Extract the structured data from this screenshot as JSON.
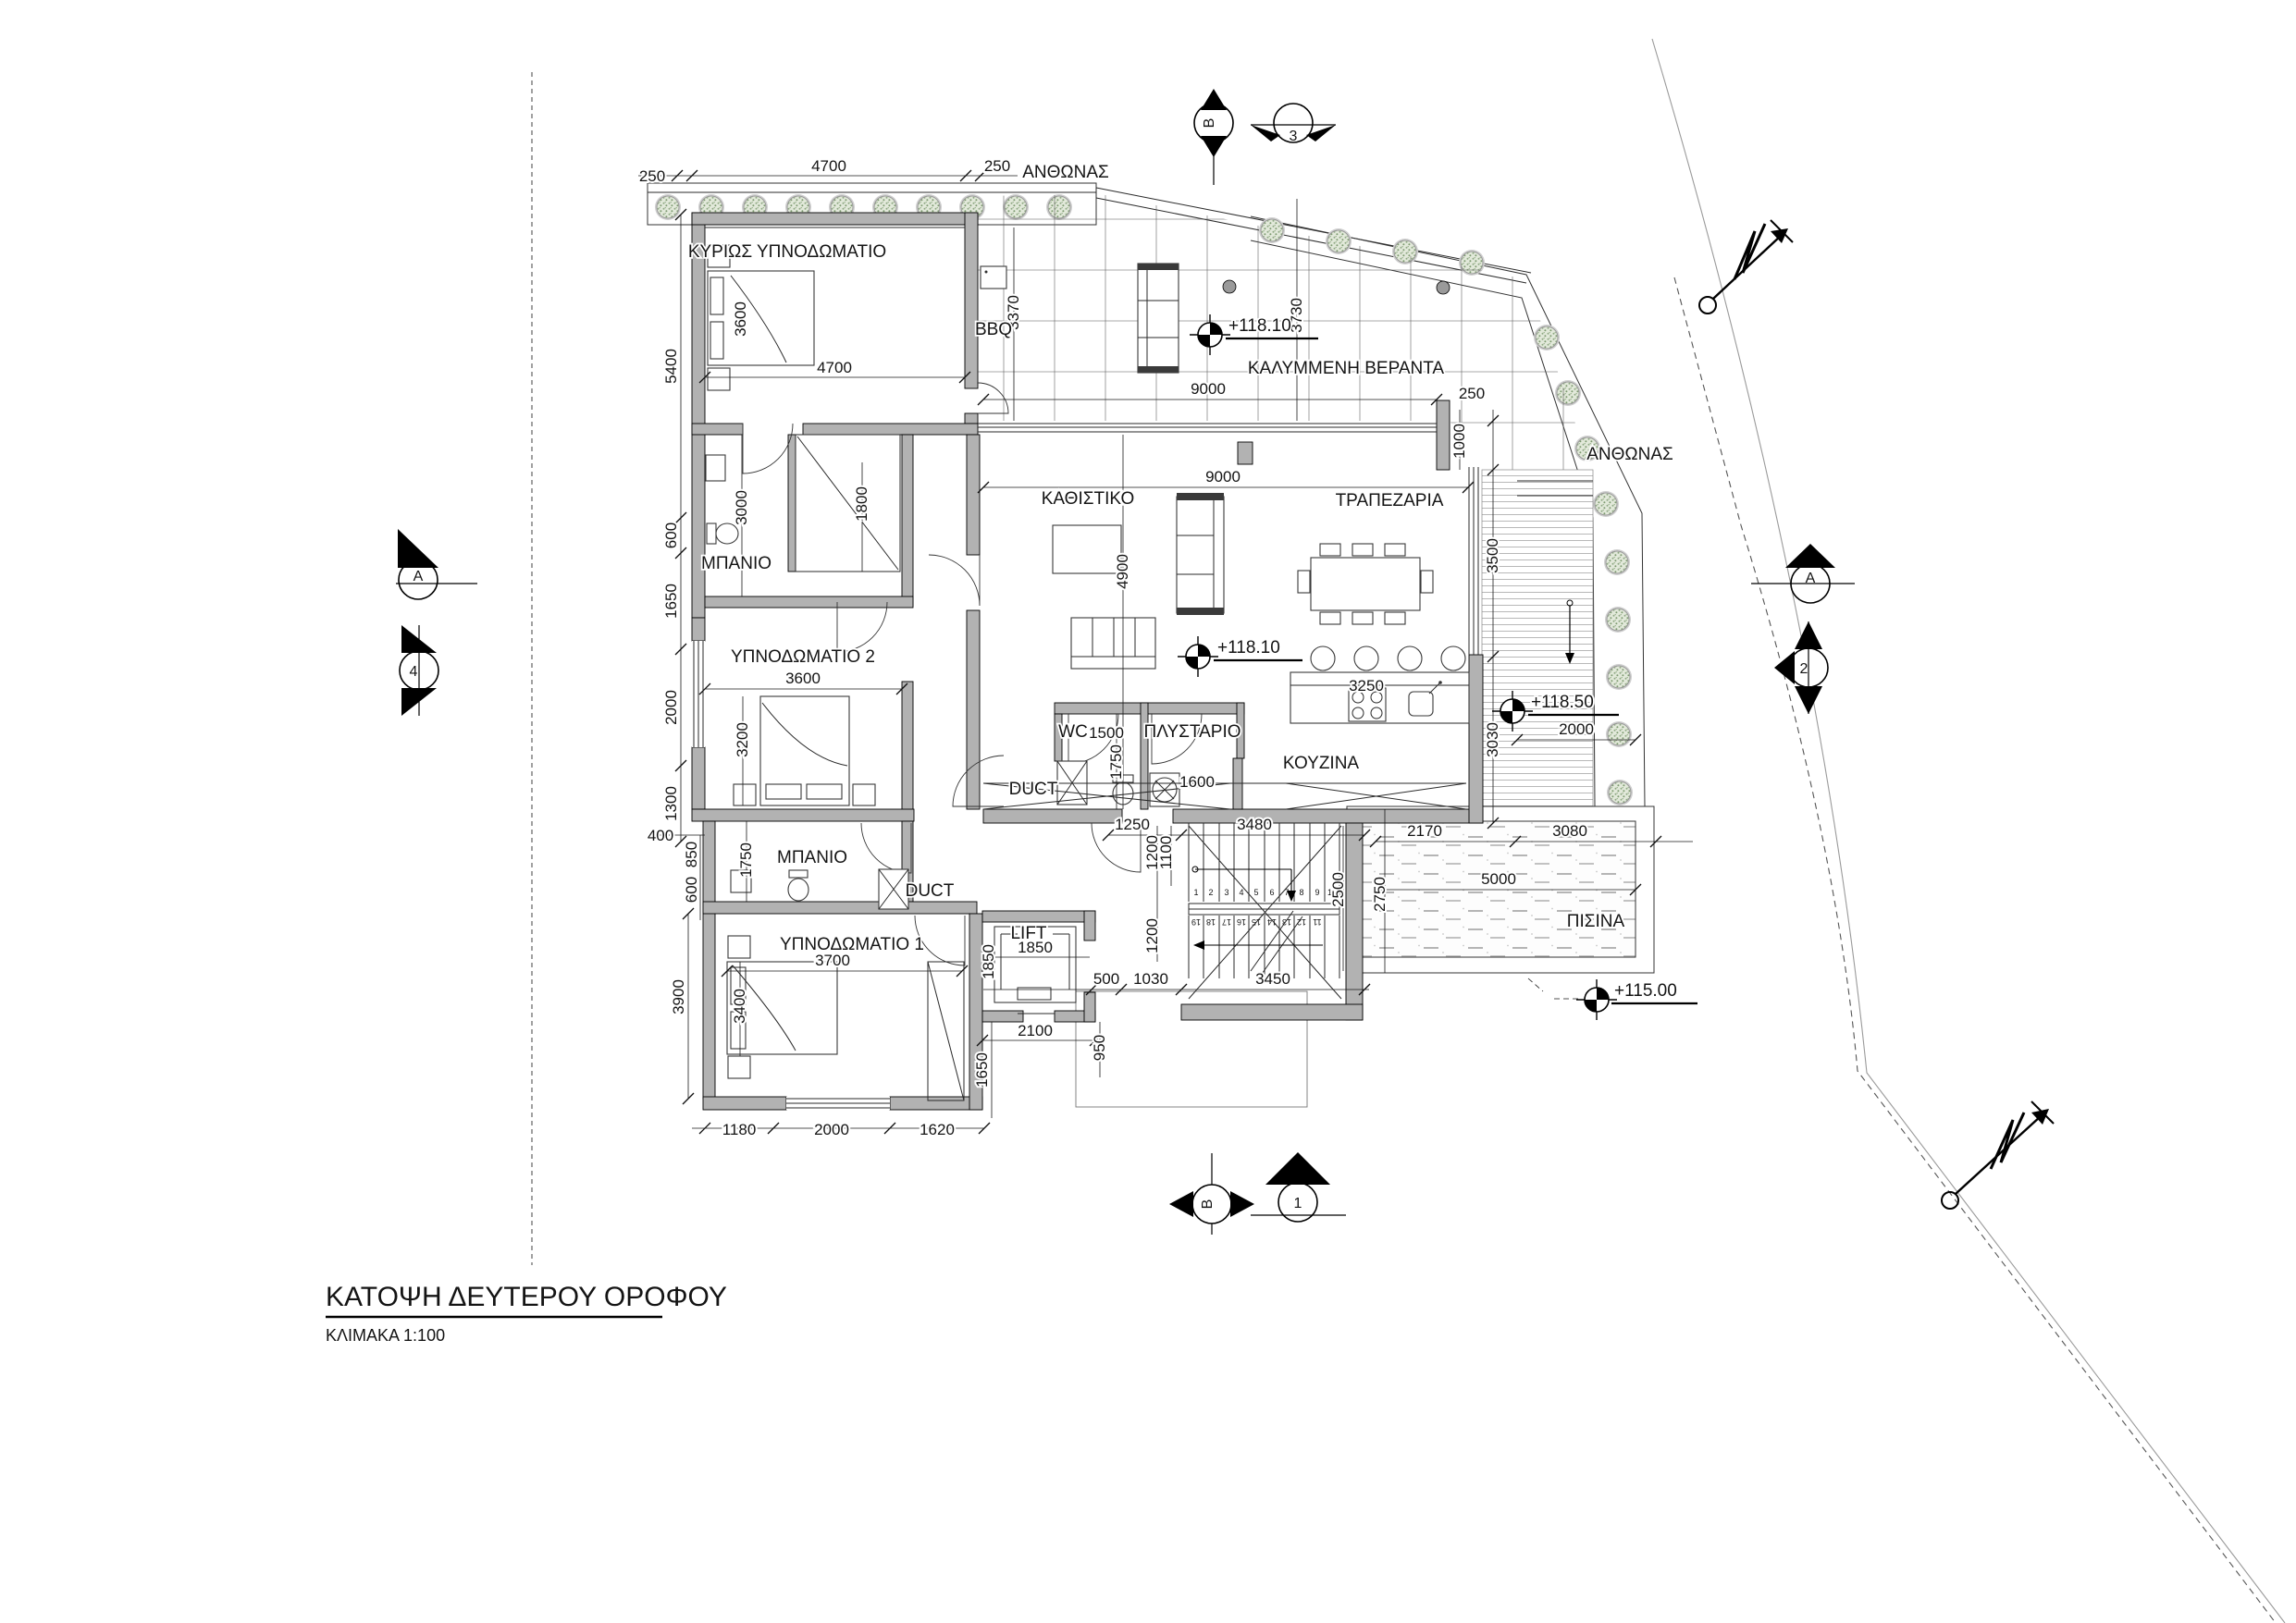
{
  "title": {
    "main": "ΚΑΤΟΨΗ ΔΕΥΤΕΡΟΥ ΟΡΟΦΟΥ",
    "scale": "ΚΛΙΜΑΚΑ 1:100"
  },
  "rooms": {
    "master": "ΚΥΡΙΩΣ ΥΠΝΟΔΩΜΑΤΙΟ",
    "bath1": "ΜΠΑΝΙΟ",
    "bedroom2": "ΥΠΝΟΔΩΜΑΤΙΟ 2",
    "bath2": "ΜΠΑΝΙΟ",
    "bedroom1": "ΥΠΝΟΔΩΜΑΤΙΟ 1",
    "living": "ΚΑΘΙΣΤΙΚΟ",
    "dining": "ΤΡΑΠΕΖΑΡΙΑ",
    "kitchen": "ΚΟΥΖΙΝΑ",
    "wc": "WC",
    "laundry": "ΠΛΥΣΤΑΡΙΟ",
    "duct1": "DUCT",
    "duct2": "DUCT",
    "lift": "LIFT",
    "veranda": "ΚΑΛΥΜΜΕΝΗ ΒΕΡΑΝΤΑ",
    "planter_top": "ΑΝΘΩΝΑΣ",
    "planter_right": "ΑΝΘΩΝΑΣ",
    "pool": "ΠΙΣΙΝΑ",
    "bbq": "BBQ"
  },
  "levels": {
    "veranda": "+118.10",
    "living": "+118.10",
    "deck": "+118.50",
    "pool": "+115.00"
  },
  "sections": {
    "top_b": "B",
    "top_3": "3",
    "left_a": "A",
    "left_4": "4",
    "right_a": "A",
    "right_2": "2",
    "bottom_b": "B",
    "bottom_1": "1"
  },
  "dims": {
    "top_250_l": "250",
    "top_4700": "4700",
    "top_250_r": "250",
    "master_w": "4700",
    "master_h": "5400",
    "master_bed": "3600",
    "left_600": "600",
    "left_1650": "1650",
    "left_2000": "2000",
    "left_1300": "1300",
    "left_400": "400",
    "left_850": "850",
    "left_600b": "600",
    "left_3900": "3900",
    "bath1_3000": "3000",
    "closet_1800": "1800",
    "br2_w": "3600",
    "br2_bed": "3200",
    "bath2_1750": "1750",
    "br1_w": "3700",
    "br1_bed": "3400",
    "bot_1180": "1180",
    "bot_2000": "2000",
    "bot_1620": "1620",
    "lift_w": "1850",
    "lift_h": "1850",
    "lift_2100": "2100",
    "lift_1650": "1650",
    "lift_950": "950",
    "s_500": "500",
    "s_1030": "1030",
    "s_3450": "3450",
    "st_1250": "1250",
    "st_1200a": "1200",
    "st_1100": "1100",
    "st_1200b": "1200",
    "st_3480": "3480",
    "st_2500": "2500",
    "st_2750": "2750",
    "pool_2170": "2170",
    "pool_3080": "3080",
    "pool_5000": "5000",
    "isl_3250": "3250",
    "wc_1500": "1500",
    "wc_1750": "1750",
    "lau_1600": "1600",
    "liv_9000": "9000",
    "liv_4900": "4900",
    "ver_9000": "9000",
    "ver_3730": "3730",
    "ver_3370": "3370",
    "ver_250": "250",
    "ver_1000": "1000",
    "right_3500": "3500",
    "deck_3030": "3030",
    "deck_2000": "2000"
  },
  "stairs": {
    "steps": [
      "1",
      "2",
      "3",
      "4",
      "5",
      "6",
      "7",
      "8",
      "9",
      "10",
      "11",
      "12",
      "13",
      "14",
      "15",
      "16",
      "17",
      "18",
      "19"
    ]
  },
  "colors": {
    "wall": "#b2b2b2",
    "tree_fill": "#8fa883",
    "accent": "#000000"
  }
}
